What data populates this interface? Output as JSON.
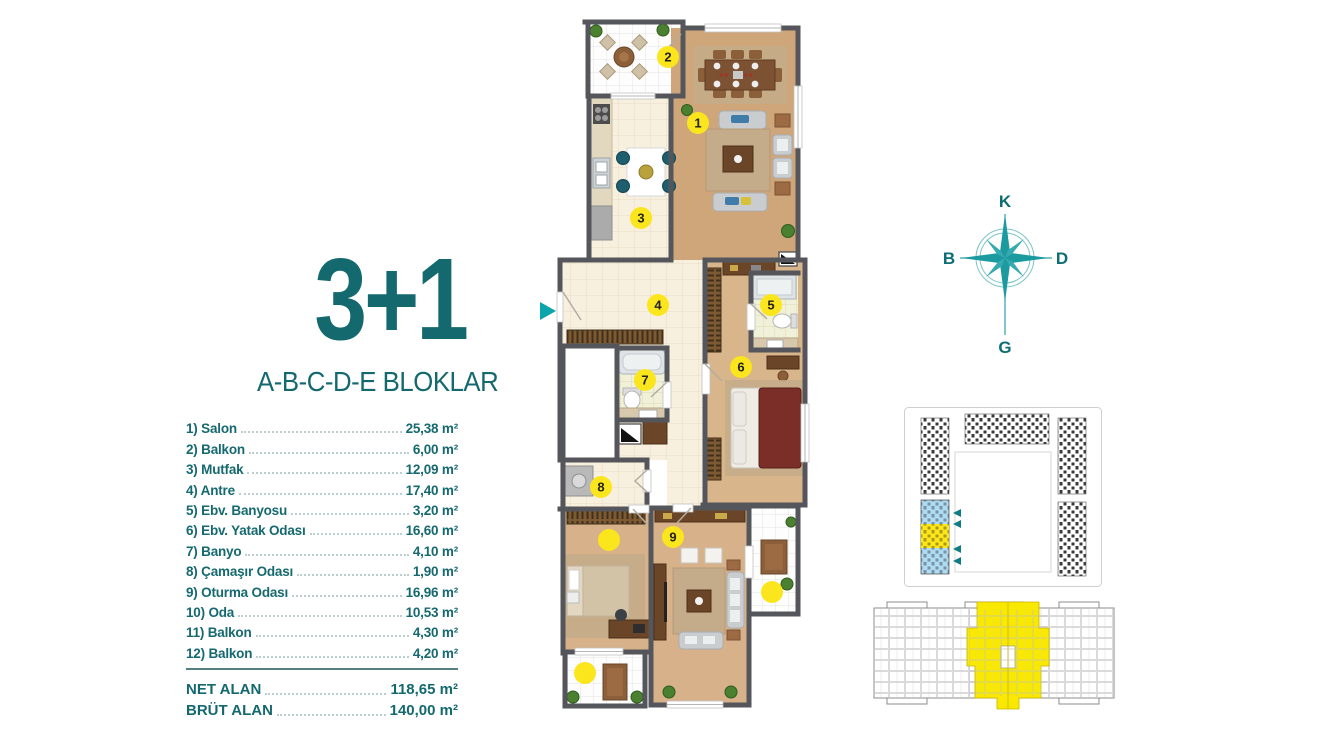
{
  "title": {
    "main": "3+1",
    "subtitle": "A-B-C-D-E BLOKLAR"
  },
  "rooms": [
    {
      "label": "1) Salon",
      "area": "25,38 m²"
    },
    {
      "label": "2) Balkon",
      "area": "6,00 m²"
    },
    {
      "label": "3) Mutfak",
      "area": "12,09 m²"
    },
    {
      "label": "4) Antre",
      "area": "17,40 m²"
    },
    {
      "label": "5) Ebv. Banyosu",
      "area": "3,20 m²"
    },
    {
      "label": "6) Ebv. Yatak Odası",
      "area": "16,60 m²"
    },
    {
      "label": "7) Banyo",
      "area": "4,10 m²"
    },
    {
      "label": "8) Çamaşır Odası",
      "area": "1,90 m²"
    },
    {
      "label": "9) Oturma Odası",
      "area": "16,96 m²"
    },
    {
      "label": "10) Oda",
      "area": "10,53 m²"
    },
    {
      "label": "11) Balkon",
      "area": "4,30 m²"
    },
    {
      "label": "12) Balkon",
      "area": "4,20 m²"
    }
  ],
  "totals": {
    "net": {
      "label": "NET ALAN",
      "value": "118,65 m²"
    },
    "brut": {
      "label": "BRÜT ALAN",
      "value": "140,00 m²"
    }
  },
  "compass": {
    "north": "K",
    "east": "D",
    "south": "G",
    "west": "B"
  },
  "floorplan": {
    "markers": [
      {
        "label": "1"
      },
      {
        "label": "2"
      },
      {
        "label": "3"
      },
      {
        "label": "4"
      },
      {
        "label": "5"
      },
      {
        "label": "6"
      },
      {
        "label": "7"
      },
      {
        "label": "8"
      },
      {
        "label": "9"
      },
      {
        "label": ""
      },
      {
        "label": ""
      },
      {
        "label": ""
      }
    ]
  },
  "colors": {
    "teal_text": "#14696f",
    "teal_compass": "#1b9aa0",
    "entry_arrow": "#0ba4ab",
    "marker_yellow": "#fbe51d",
    "wall_gray": "#55565b",
    "site_highlight_blue": "#aedcf4",
    "site_highlight_yellow": "#ffe715",
    "overview_yellow": "#f9e800"
  }
}
